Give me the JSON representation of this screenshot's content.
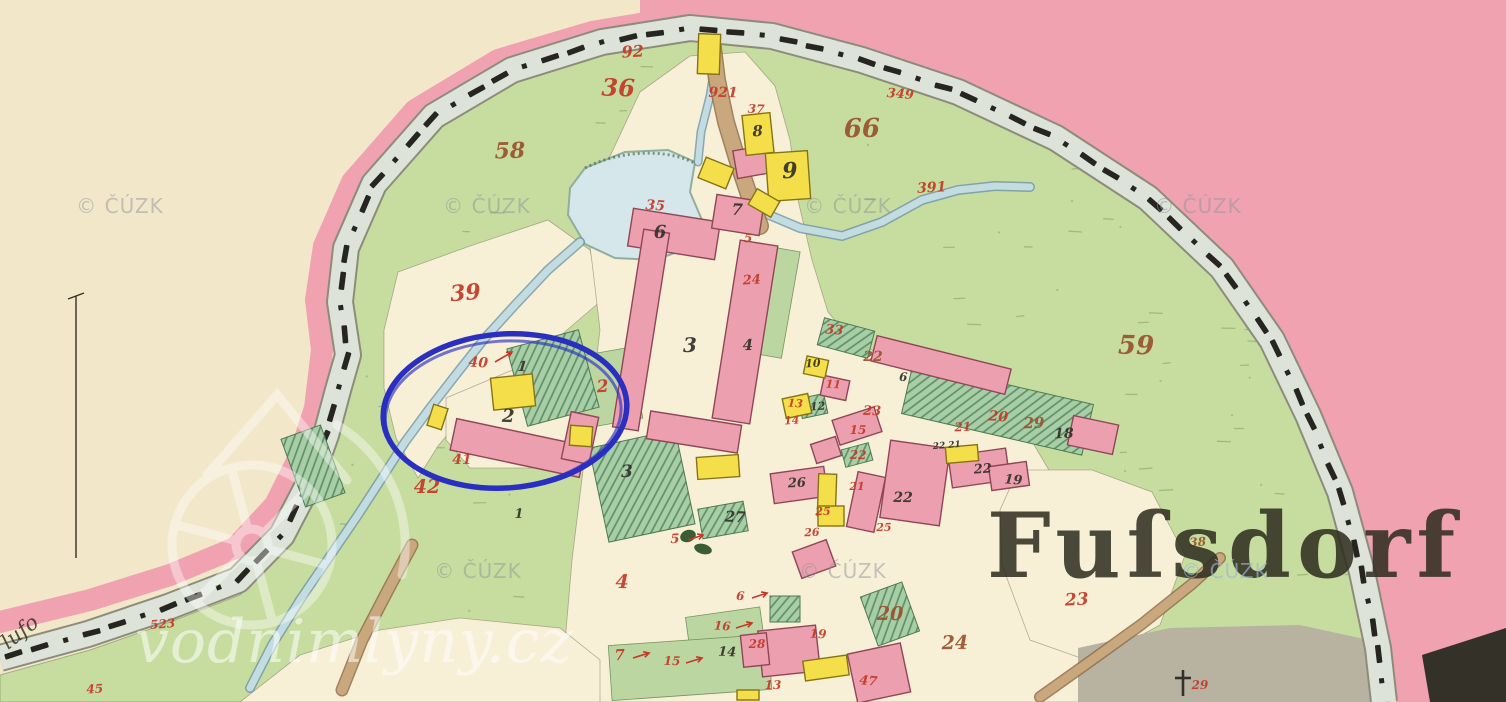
{
  "map": {
    "place_label": {
      "text": "Fuſsdorf"
    },
    "handwriting_label": {
      "text": "lufo"
    },
    "watermarks": {
      "cuzk_text": "© ČÚZK",
      "cuzk_positions": [
        [
          120,
          213
        ],
        [
          487,
          213
        ],
        [
          848,
          213
        ],
        [
          1198,
          213
        ],
        [
          478,
          578
        ],
        [
          843,
          578
        ],
        [
          1225,
          578
        ]
      ],
      "site_text": "vodnimlyny.cz"
    },
    "annotation_ellipse": {
      "cx": 505,
      "cy": 411,
      "rx": 122,
      "ry": 77,
      "rotate": -4,
      "color": "#2a2fc0"
    },
    "palette": {
      "paper": "#f3e7ca",
      "border_band": "#f0a2b0",
      "road_fill": "#dde3d9",
      "road_edge": "#8c8c7a",
      "fence_ink": "#26251f",
      "meadow": "#c7dd9f",
      "meadow_mark": "#7f9e60",
      "field_cream": "#f8efd7",
      "pond": "#d5e7ea",
      "stream": "#c2dce2",
      "stream_edge": "#6f95a6",
      "path_brown": "#c9a87e",
      "path_edge": "#8f6f4c",
      "masonry": "#ec9fae",
      "masonry_edge": "#8f4656",
      "wood": "#f4df4a",
      "wood_edge": "#857413",
      "garden": "#a8cea7",
      "garden_hatch": "#5d8d62",
      "meadow_patch": "#bcd6a2",
      "red_number": "#c13a28",
      "brown_number": "#9a5230",
      "black_ink": "#33312a",
      "gray_zone": "#b8b2a1",
      "dark_corner": "#343128",
      "watermark_gray": "#8e959b",
      "watermark_blue": "#9db6d8",
      "white": "#ffffff"
    },
    "parcel_numbers": [
      [
        "92",
        633,
        57,
        16,
        "r"
      ],
      [
        "36",
        618,
        96,
        24,
        "r"
      ],
      [
        "921",
        723,
        97,
        14,
        "r"
      ],
      [
        "37",
        756,
        113,
        12,
        "r"
      ],
      [
        "349",
        900,
        98,
        13,
        "r"
      ],
      [
        "66",
        862,
        137,
        26,
        "b"
      ],
      [
        "58",
        510,
        158,
        22,
        "b"
      ],
      [
        "391",
        932,
        192,
        14,
        "r"
      ],
      [
        "35",
        655,
        210,
        14,
        "r"
      ],
      [
        "5",
        748,
        242,
        12,
        "r"
      ],
      [
        "24",
        752,
        284,
        13,
        "r"
      ],
      [
        "39",
        466,
        300,
        22,
        "r"
      ],
      [
        "40",
        478,
        367,
        14,
        "r"
      ],
      [
        "2",
        603,
        392,
        17,
        "r"
      ],
      [
        "41",
        462,
        464,
        14,
        "r"
      ],
      [
        "42",
        427,
        493,
        19,
        "r"
      ],
      [
        "59",
        1136,
        354,
        26,
        "b"
      ],
      [
        "33",
        834,
        334,
        13,
        "r"
      ],
      [
        "22",
        873,
        361,
        14,
        "b"
      ],
      [
        "23",
        872,
        415,
        13,
        "r"
      ],
      [
        "15",
        858,
        434,
        12,
        "r"
      ],
      [
        "11",
        833,
        388,
        11,
        "r"
      ],
      [
        "13",
        795,
        407,
        11,
        "r"
      ],
      [
        "14",
        792,
        424,
        11,
        "r"
      ],
      [
        "21",
        963,
        431,
        12,
        "r"
      ],
      [
        "20",
        998,
        421,
        14,
        "r"
      ],
      [
        "29",
        1034,
        428,
        15,
        "b"
      ],
      [
        "22",
        858,
        459,
        12,
        "r"
      ],
      [
        "21",
        857,
        490,
        11,
        "r"
      ],
      [
        "25",
        823,
        515,
        11,
        "r"
      ],
      [
        "26",
        812,
        536,
        11,
        "r"
      ],
      [
        "25",
        884,
        531,
        11,
        "r"
      ],
      [
        "5",
        675,
        543,
        13,
        "r"
      ],
      [
        "4",
        622,
        588,
        19,
        "r"
      ],
      [
        "6",
        740,
        600,
        12,
        "r"
      ],
      [
        "16",
        722,
        630,
        12,
        "r"
      ],
      [
        "7",
        620,
        660,
        15,
        "r"
      ],
      [
        "15",
        672,
        665,
        12,
        "r"
      ],
      [
        "28",
        757,
        648,
        12,
        "r"
      ],
      [
        "13",
        773,
        689,
        12,
        "r"
      ],
      [
        "19",
        818,
        638,
        12,
        "r"
      ],
      [
        "20",
        890,
        620,
        19,
        "b"
      ],
      [
        "24",
        955,
        649,
        19,
        "b"
      ],
      [
        "47",
        868,
        685,
        13,
        "r"
      ],
      [
        "23",
        1077,
        605,
        17,
        "r"
      ],
      [
        "29",
        1200,
        689,
        12,
        "r"
      ],
      [
        "523",
        163,
        628,
        12,
        "r"
      ],
      [
        "45",
        95,
        693,
        12,
        "r"
      ],
      [
        "38",
        1198,
        546,
        12,
        "b"
      ]
    ],
    "house_numbers": [
      [
        "8",
        758,
        136,
        15
      ],
      [
        "9",
        790,
        178,
        22
      ],
      [
        "7",
        737,
        215,
        16
      ],
      [
        "6",
        660,
        238,
        18
      ],
      [
        "3",
        690,
        352,
        20
      ],
      [
        "4",
        748,
        350,
        15
      ],
      [
        "1",
        522,
        371,
        14
      ],
      [
        "2",
        508,
        422,
        18
      ],
      [
        "1",
        519,
        518,
        13
      ],
      [
        "3",
        627,
        477,
        17
      ],
      [
        "27",
        735,
        522,
        15
      ],
      [
        "26",
        797,
        487,
        13
      ],
      [
        "22",
        903,
        502,
        14
      ],
      [
        "10",
        813,
        367,
        11
      ],
      [
        "12",
        818,
        410,
        11
      ],
      [
        "6",
        903,
        381,
        12
      ],
      [
        "18",
        1064,
        438,
        14
      ],
      [
        "22",
        983,
        473,
        13
      ],
      [
        "19",
        1013,
        484,
        13
      ],
      [
        "22 21",
        947,
        448,
        9
      ],
      [
        "14",
        727,
        656,
        13
      ]
    ],
    "buildings_masonry": [
      [
        452,
        432,
        132,
        32,
        12
      ],
      [
        566,
        414,
        28,
        48,
        12
      ],
      [
        630,
        215,
        88,
        38,
        9
      ],
      [
        714,
        198,
        48,
        34,
        9
      ],
      [
        628,
        230,
        26,
        200,
        9
      ],
      [
        726,
        242,
        38,
        180,
        9
      ],
      [
        648,
        418,
        92,
        28,
        9
      ],
      [
        735,
        148,
        32,
        28,
        -10
      ],
      [
        872,
        352,
        138,
        26,
        14
      ],
      [
        1070,
        420,
        46,
        30,
        12
      ],
      [
        822,
        378,
        26,
        20,
        12
      ],
      [
        835,
        413,
        44,
        26,
        -18
      ],
      [
        813,
        440,
        26,
        20,
        -18
      ],
      [
        772,
        470,
        54,
        30,
        -8
      ],
      [
        852,
        474,
        28,
        56,
        12
      ],
      [
        885,
        444,
        60,
        78,
        8
      ],
      [
        950,
        452,
        58,
        32,
        -8
      ],
      [
        990,
        464,
        38,
        24,
        -8
      ],
      [
        760,
        628,
        58,
        46,
        -6
      ],
      [
        852,
        648,
        54,
        50,
        -12
      ],
      [
        742,
        634,
        26,
        32,
        -6
      ],
      [
        796,
        545,
        36,
        28,
        -20
      ]
    ],
    "buildings_wood": [
      [
        492,
        376,
        42,
        32,
        -6
      ],
      [
        570,
        426,
        22,
        20,
        4
      ],
      [
        430,
        406,
        15,
        22,
        18
      ],
      [
        744,
        114,
        28,
        40,
        -6
      ],
      [
        767,
        152,
        42,
        48,
        -4
      ],
      [
        701,
        162,
        30,
        22,
        22
      ],
      [
        751,
        194,
        26,
        18,
        30
      ],
      [
        698,
        34,
        22,
        40,
        2
      ],
      [
        805,
        358,
        22,
        18,
        12
      ],
      [
        784,
        396,
        26,
        20,
        -12
      ],
      [
        818,
        474,
        18,
        42,
        2
      ],
      [
        946,
        446,
        32,
        16,
        -5
      ],
      [
        818,
        506,
        26,
        20,
        0
      ],
      [
        804,
        658,
        44,
        20,
        -8
      ],
      [
        697,
        456,
        42,
        22,
        -4
      ],
      [
        737,
        690,
        22,
        10,
        0
      ]
    ],
    "gardens_hatched": [
      [
        516,
        338,
        74,
        80,
        -15
      ],
      [
        598,
        438,
        88,
        96,
        -12
      ],
      [
        820,
        324,
        52,
        28,
        15
      ],
      [
        905,
        383,
        185,
        52,
        13
      ],
      [
        800,
        396,
        26,
        20,
        -12
      ],
      [
        843,
        446,
        28,
        18,
        -15
      ],
      [
        292,
        430,
        42,
        72,
        -20
      ],
      [
        868,
        588,
        44,
        52,
        -20
      ],
      [
        700,
        505,
        46,
        30,
        -10
      ],
      [
        770,
        596,
        30,
        26,
        0
      ]
    ],
    "meadow_patches": [
      [
        755,
        248,
        36,
        108,
        10
      ],
      [
        575,
        352,
        62,
        72,
        -10
      ],
      [
        688,
        612,
        75,
        42,
        -8
      ],
      [
        610,
        640,
        160,
        55,
        -4
      ]
    ],
    "pointer_arrows": [
      [
        495,
        362,
        512,
        352
      ],
      [
        688,
        540,
        703,
        535
      ],
      [
        752,
        598,
        767,
        593
      ],
      [
        736,
        628,
        752,
        623
      ],
      [
        633,
        658,
        649,
        653
      ],
      [
        686,
        663,
        702,
        658
      ]
    ],
    "cemetery_cross": [
      1183,
      682
    ]
  }
}
